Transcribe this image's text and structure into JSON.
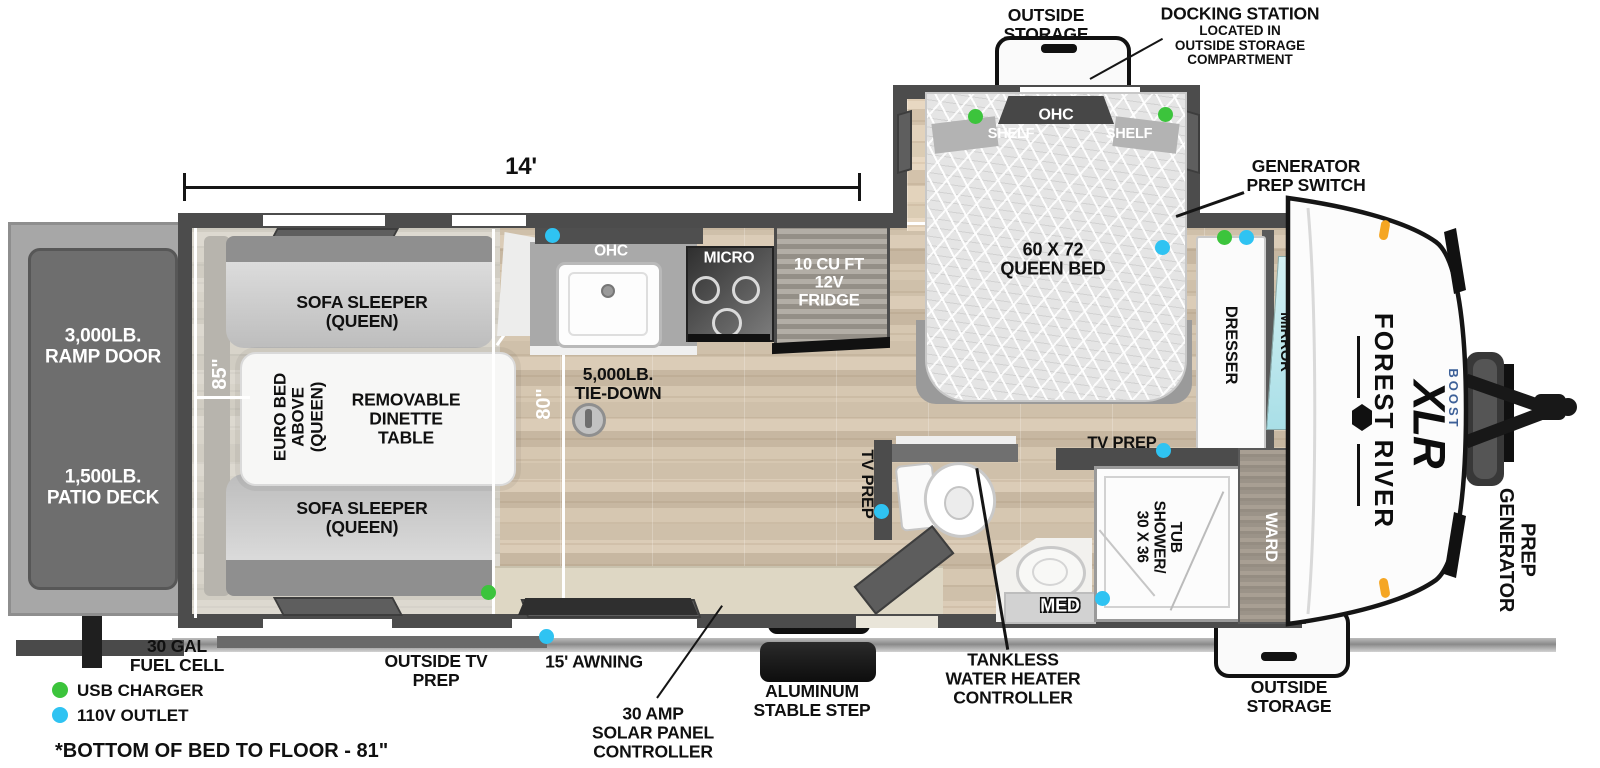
{
  "title": "Forest River XLR Boost travel trailer floorplan",
  "dimensions": {
    "overall_length": "14'",
    "garage_length": "85\"",
    "bed_clearance": "80\"",
    "bed_note_marker": "*"
  },
  "exterior": {
    "outside_storage_top": "OUTSIDE\nSTORAGE",
    "docking_station_title": "DOCKING STATION",
    "docking_station_note": "LOCATED IN\nOUTSIDE STORAGE\nCOMPARTMENT",
    "generator_prep_switch": "GENERATOR\nPREP SWITCH",
    "generator_prep": "GENERATOR\nPREP",
    "outside_storage_bottom": "OUTSIDE\nSTORAGE",
    "fuel_cell": "30 GAL\nFUEL CELL",
    "outside_tv_prep": "OUTSIDE TV\nPREP",
    "awning": "15' AWNING",
    "solar_controller": "30 AMP\nSOLAR PANEL\nCONTROLLER",
    "step": "ALUMINUM\nSTABLE STEP",
    "ramp_door": "3,000LB.\nRAMP DOOR",
    "patio_deck": "1,500LB.\nPATIO DECK"
  },
  "garage": {
    "sofa_top": "SOFA SLEEPER\n(QUEEN)",
    "sofa_bottom": "SOFA SLEEPER\n(QUEEN)",
    "euro_bed": "EURO BED\nABOVE\n(QUEEN)",
    "dinette": "REMOVABLE\nDINETTE\nTABLE",
    "tie_down": "5,000LB.\nTIE-DOWN"
  },
  "kitchen": {
    "ohc": "OHC",
    "micro": "MICRO",
    "fridge": "10 CU FT\n12V\nFRIDGE"
  },
  "bedroom": {
    "ohc": "OHC",
    "shelf_left": "SHELF",
    "shelf_right": "SHELF",
    "bed": "60 X 72\nQUEEN BED",
    "dresser": "DRESSER",
    "mirror": "MIRROR",
    "tv_prep": "TV PREP"
  },
  "bath": {
    "tv_prep": "TV PREP",
    "med": "MED",
    "shower": "30 X 36\nSHOWER/\nTUB",
    "ward": "WARD",
    "tankless": "TANKLESS\nWATER HEATER\nCONTROLLER"
  },
  "branding": {
    "make": "FOREST RIVER",
    "model": "XLR",
    "submodel": "BOOST"
  },
  "legend": {
    "usb_charger": "USB CHARGER",
    "outlet_110v": "110V OUTLET",
    "footnote": "*BOTTOM OF BED TO FLOOR - 81\""
  },
  "colors": {
    "usb_charger": "#3cc43c",
    "outlet_110v": "#2fc3f2",
    "boost_blue": "#3d6098"
  }
}
